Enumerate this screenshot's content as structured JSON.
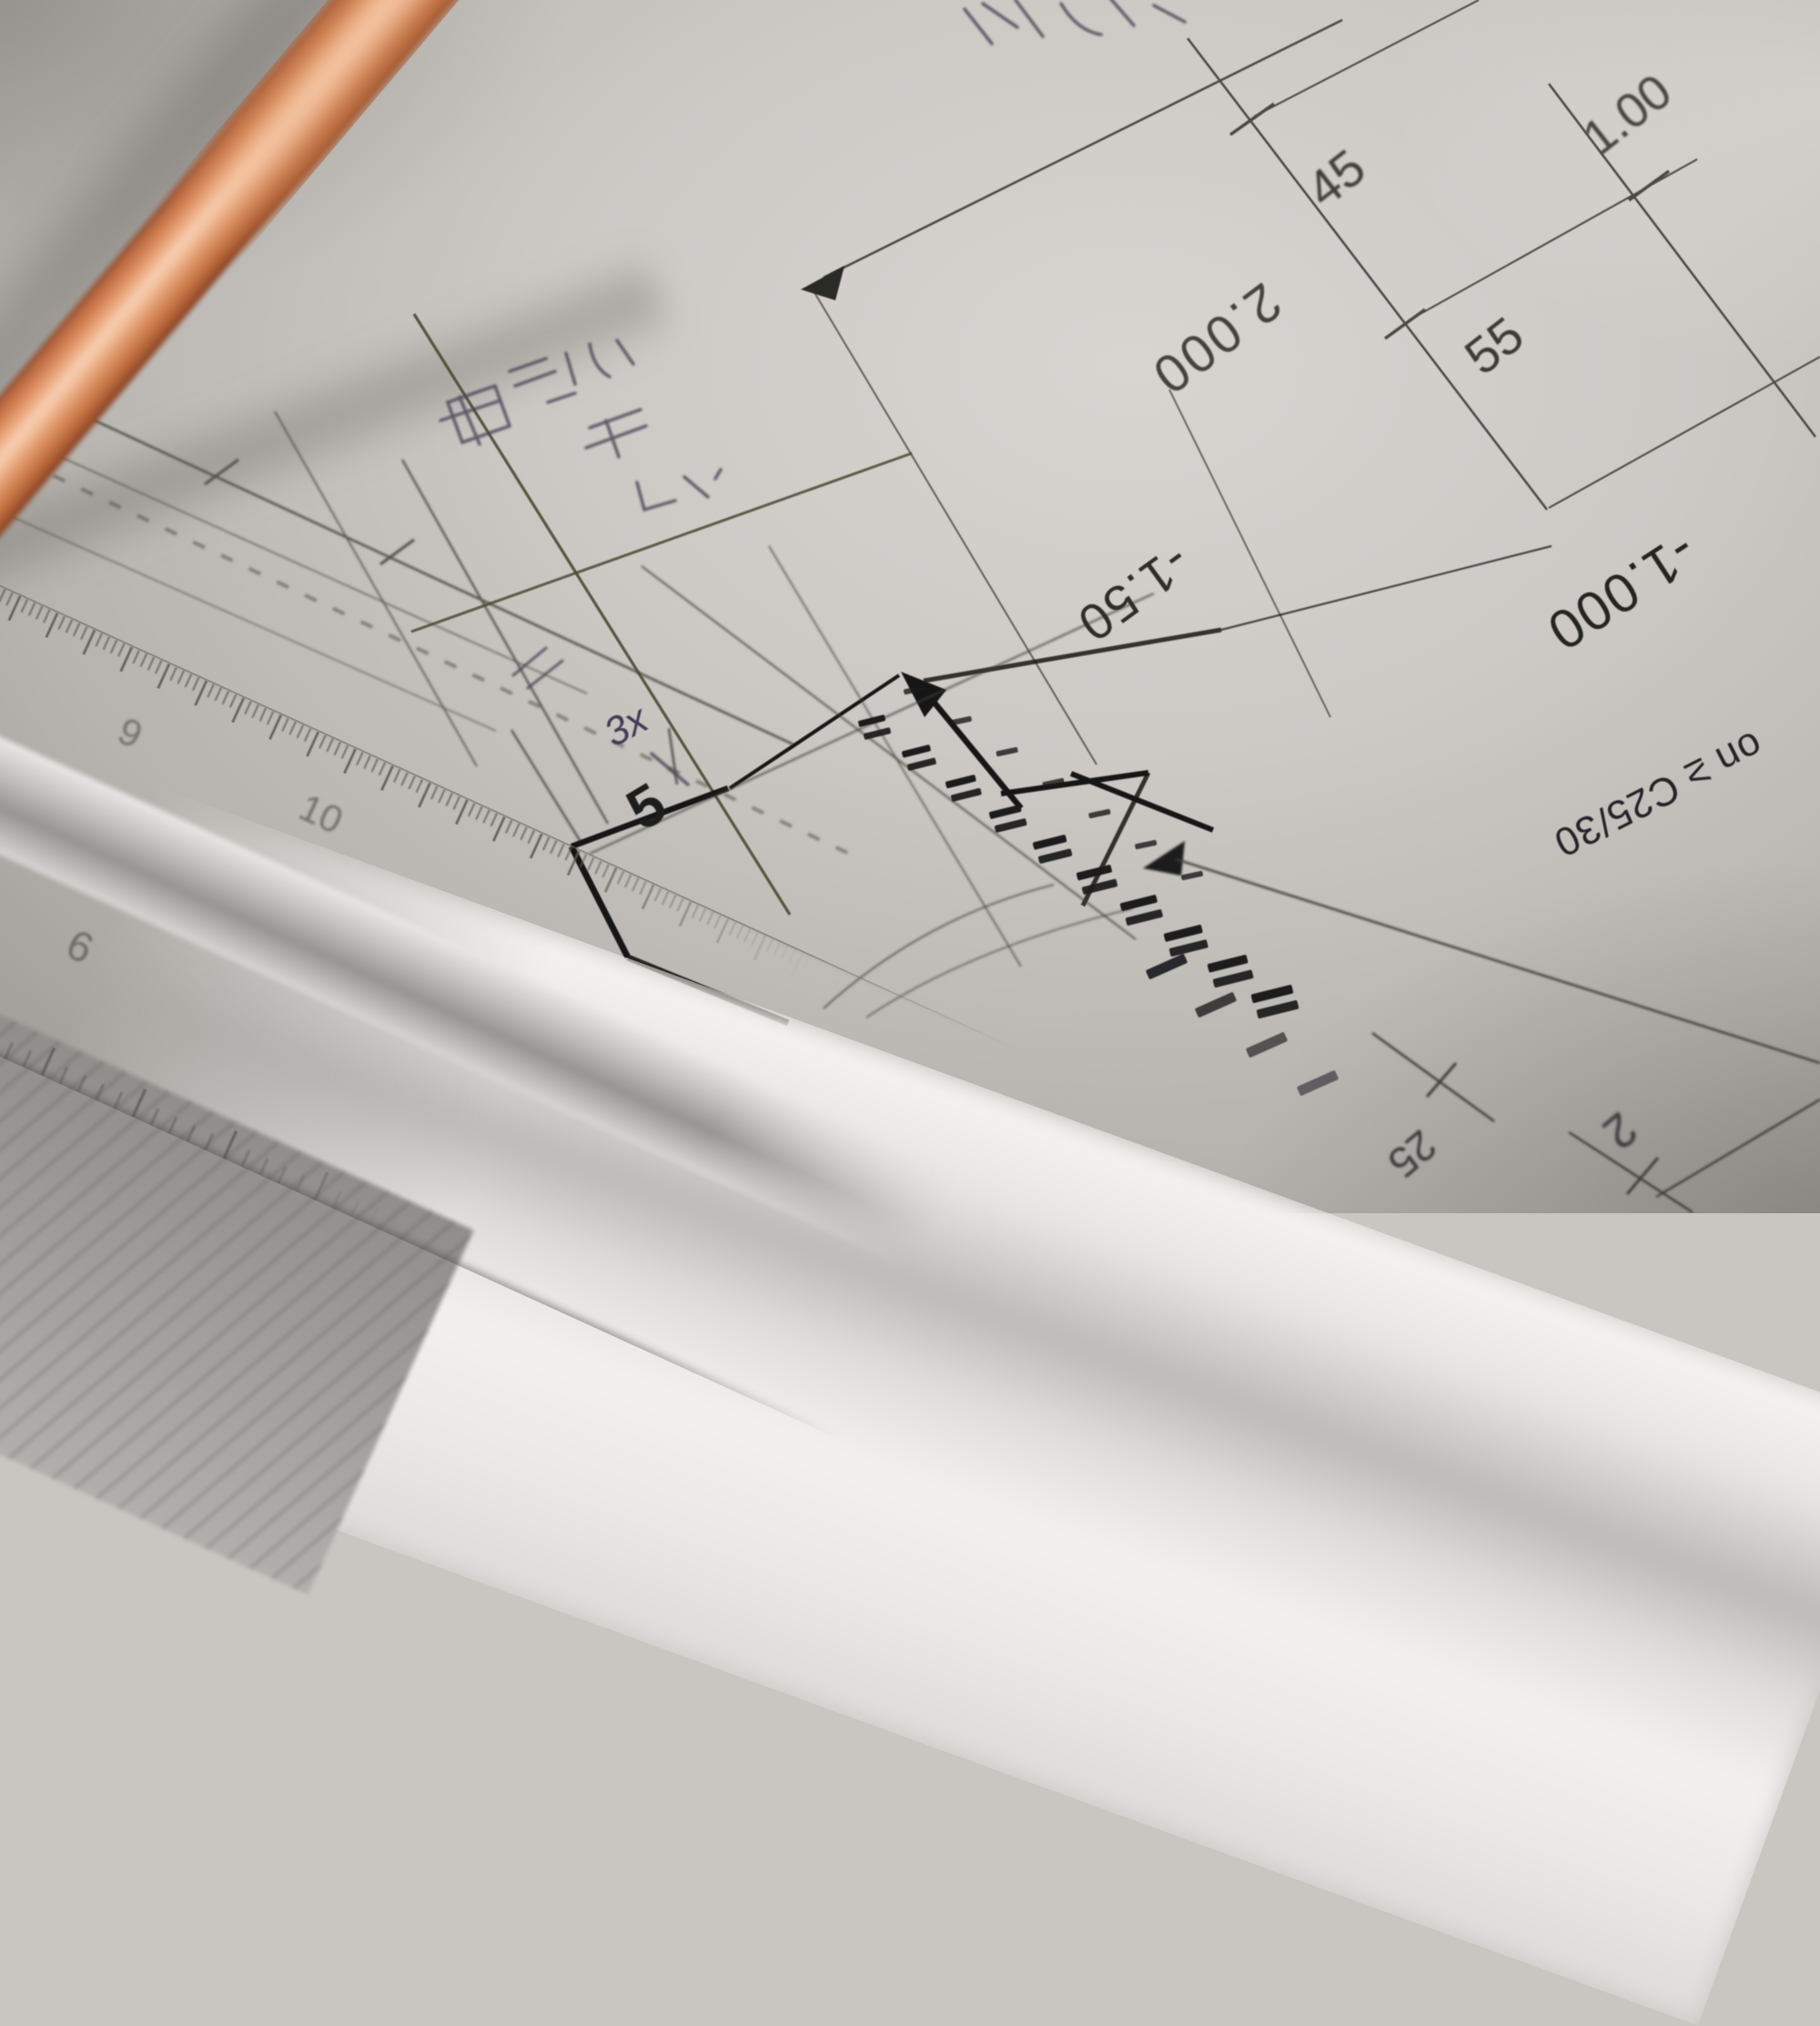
{
  "drawing": {
    "dimension_labels": {
      "d2000": "2.000",
      "d45": "45",
      "d55": "55",
      "d100": "1.00",
      "d25": "25",
      "d2": "2",
      "d5": "5"
    },
    "level_labels": {
      "minus150": "-1.50",
      "minus1000": "-1.000"
    },
    "spec_label": "on ≥ C25/30",
    "handwritten_label": "3x"
  },
  "ruler": {
    "numbers": {
      "n9": "9",
      "n10": "10",
      "n6": "6"
    }
  },
  "colors": {
    "paper": "#c9c6c2",
    "ink": "#3a3834",
    "pencil_wood": "#cd7a4d",
    "pencil_highlight": "#f6cdb0",
    "graphite": "#1a1a1a",
    "ruler_white": "#f2f1ef",
    "handwriting": "#4c4a58"
  }
}
